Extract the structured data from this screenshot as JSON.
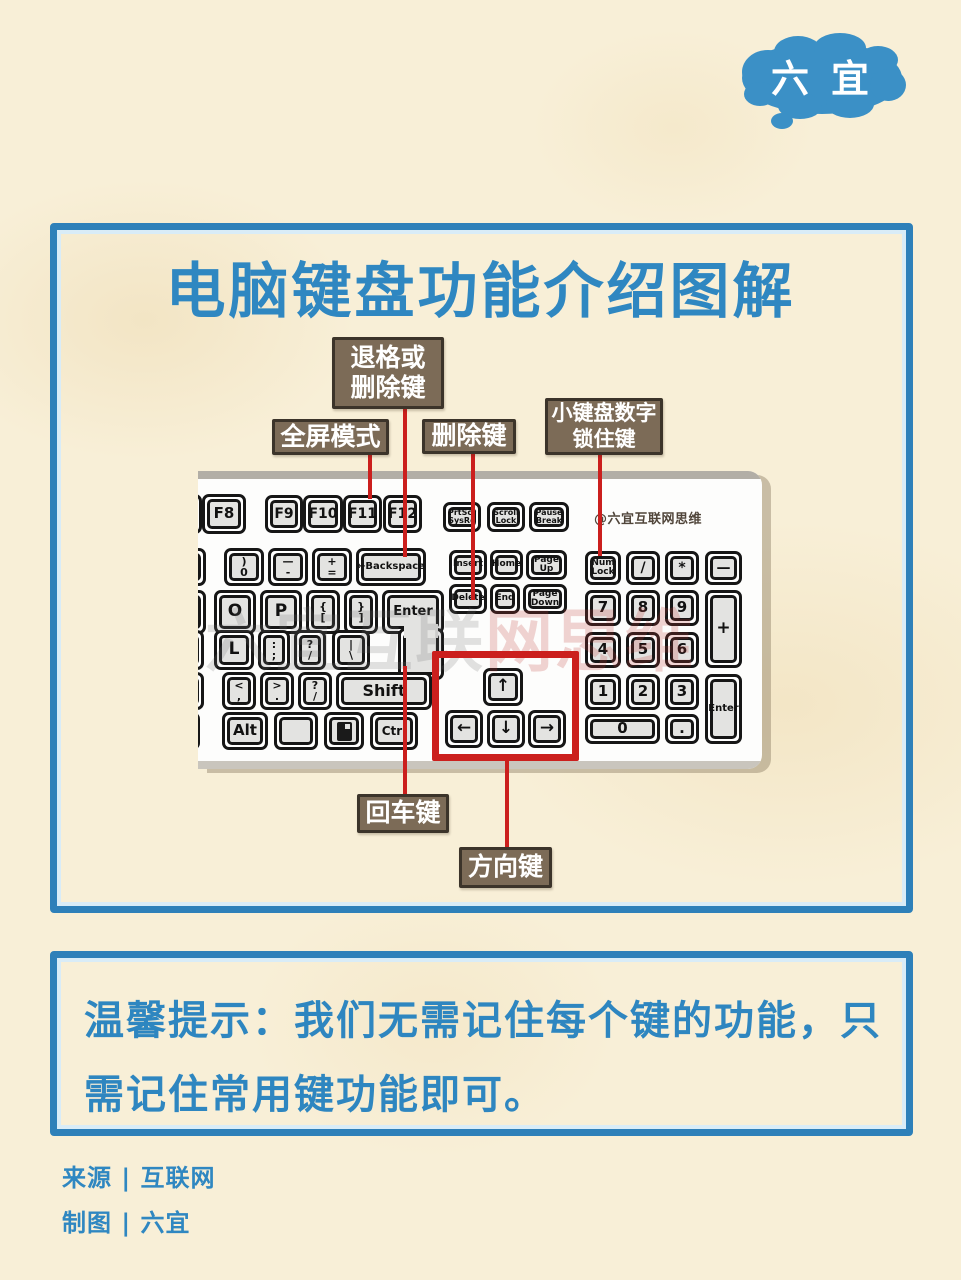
{
  "colors": {
    "accent_blue": "#2f87c1",
    "panel_border_blue": "#2e80b9",
    "label_brown": "#7c6b57",
    "label_border": "#3c342a",
    "connector_red": "#cb1f1d",
    "background_cream": "#f8efd7",
    "keycap_gray": "#e3e3e1"
  },
  "logo": {
    "chars": [
      "六",
      "宜"
    ],
    "blob_color": "#3b90c6"
  },
  "header": {
    "title": "电脑键盘功能介绍图解"
  },
  "keyboard": {
    "credit": "@六宜互联网思维",
    "watermark": {
      "gray": "六宜互联",
      "red": "网思维"
    },
    "keys": [
      {
        "x": -28,
        "y": 23,
        "w": 32,
        "h": 40,
        "lines": [],
        "name": "key-cut-left-f"
      },
      {
        "x": 4,
        "y": 23,
        "w": 44,
        "h": 40,
        "fs": 15,
        "lines": [
          "F8"
        ],
        "name": "key-f8"
      },
      {
        "x": 67,
        "y": 24,
        "w": 38,
        "h": 38,
        "fs": 14,
        "lines": [
          "F9"
        ],
        "name": "key-f9"
      },
      {
        "x": 105,
        "y": 24,
        "w": 40,
        "h": 38,
        "fs": 14,
        "lines": [
          "F10"
        ],
        "name": "key-f10"
      },
      {
        "x": 145,
        "y": 24,
        "w": 39,
        "h": 38,
        "fs": 14,
        "lines": [
          "F11"
        ],
        "name": "key-f11"
      },
      {
        "x": 185,
        "y": 24,
        "w": 39,
        "h": 38,
        "fs": 14,
        "lines": [
          "F12"
        ],
        "name": "key-f12"
      },
      {
        "x": 245,
        "y": 31,
        "w": 38,
        "h": 30,
        "fs": 8,
        "lines": [
          "PrtScr",
          "SysRq"
        ],
        "name": "key-prtscr"
      },
      {
        "x": 289,
        "y": 31,
        "w": 38,
        "h": 30,
        "fs": 8,
        "lines": [
          "Scroll",
          "Lock"
        ],
        "name": "key-scroll-lock"
      },
      {
        "x": 331,
        "y": 31,
        "w": 40,
        "h": 30,
        "fs": 8,
        "lines": [
          "Pause",
          "Break"
        ],
        "name": "key-pause"
      },
      {
        "x": -26,
        "y": 77,
        "w": 34,
        "h": 38,
        "lines": [],
        "name": "key-cut-left-num"
      },
      {
        "x": 26,
        "y": 77,
        "w": 40,
        "h": 38,
        "fs": 11,
        "lines": [
          ")",
          "0"
        ],
        "name": "key-0"
      },
      {
        "x": 70,
        "y": 77,
        "w": 40,
        "h": 38,
        "fs": 11,
        "lines": [
          "—",
          "-"
        ],
        "name": "key-minus"
      },
      {
        "x": 114,
        "y": 77,
        "w": 40,
        "h": 38,
        "fs": 11,
        "lines": [
          "+",
          "="
        ],
        "name": "key-equals"
      },
      {
        "x": 158,
        "y": 77,
        "w": 70,
        "h": 38,
        "fs": 10,
        "lines": [
          "←Backspace"
        ],
        "name": "key-backspace"
      },
      {
        "x": 251,
        "y": 79,
        "w": 38,
        "h": 30,
        "fs": 9,
        "lines": [
          "Insert"
        ],
        "name": "key-insert"
      },
      {
        "x": 292,
        "y": 79,
        "w": 33,
        "h": 30,
        "fs": 9,
        "lines": [
          "Home"
        ],
        "name": "key-home"
      },
      {
        "x": 328,
        "y": 79,
        "w": 41,
        "h": 30,
        "fs": 9,
        "lines": [
          "Page",
          "Up"
        ],
        "name": "key-page-up"
      },
      {
        "x": 251,
        "y": 113,
        "w": 38,
        "h": 30,
        "fs": 9,
        "lines": [
          "Delete"
        ],
        "name": "key-delete"
      },
      {
        "x": 292,
        "y": 113,
        "w": 30,
        "h": 30,
        "fs": 9,
        "lines": [
          "End"
        ],
        "name": "key-end"
      },
      {
        "x": 325,
        "y": 113,
        "w": 44,
        "h": 30,
        "fs": 9,
        "lines": [
          "Page",
          "Down"
        ],
        "name": "key-page-down"
      },
      {
        "x": 387,
        "y": 80,
        "w": 36,
        "h": 34,
        "fs": 9,
        "lines": [
          "Num",
          "Lock"
        ],
        "name": "key-num-lock"
      },
      {
        "x": 428,
        "y": 80,
        "w": 34,
        "h": 34,
        "fs": 14,
        "lines": [
          "/"
        ],
        "name": "key-numpad-divide"
      },
      {
        "x": 467,
        "y": 80,
        "w": 34,
        "h": 34,
        "fs": 14,
        "lines": [
          "*"
        ],
        "name": "key-numpad-multiply"
      },
      {
        "x": 507,
        "y": 80,
        "w": 37,
        "h": 34,
        "fs": 14,
        "lines": [
          "—"
        ],
        "name": "key-numpad-minus"
      },
      {
        "x": 387,
        "y": 119,
        "w": 36,
        "h": 36,
        "fs": 15,
        "lines": [
          "7"
        ],
        "name": "key-numpad-7"
      },
      {
        "x": 428,
        "y": 119,
        "w": 34,
        "h": 36,
        "fs": 15,
        "lines": [
          "8"
        ],
        "name": "key-numpad-8"
      },
      {
        "x": 467,
        "y": 119,
        "w": 34,
        "h": 36,
        "fs": 15,
        "lines": [
          "9"
        ],
        "name": "key-numpad-9"
      },
      {
        "x": 507,
        "y": 119,
        "w": 37,
        "h": 78,
        "fs": 17,
        "lines": [
          "+"
        ],
        "name": "key-numpad-plus"
      },
      {
        "x": 387,
        "y": 161,
        "w": 36,
        "h": 36,
        "fs": 15,
        "lines": [
          "4"
        ],
        "name": "key-numpad-4"
      },
      {
        "x": 428,
        "y": 161,
        "w": 34,
        "h": 36,
        "fs": 15,
        "lines": [
          "5"
        ],
        "name": "key-numpad-5"
      },
      {
        "x": 467,
        "y": 161,
        "w": 34,
        "h": 36,
        "fs": 15,
        "lines": [
          "6"
        ],
        "name": "key-numpad-6"
      },
      {
        "x": 387,
        "y": 203,
        "w": 36,
        "h": 36,
        "fs": 15,
        "lines": [
          "1"
        ],
        "name": "key-numpad-1"
      },
      {
        "x": 428,
        "y": 203,
        "w": 34,
        "h": 36,
        "fs": 15,
        "lines": [
          "2"
        ],
        "name": "key-numpad-2"
      },
      {
        "x": 467,
        "y": 203,
        "w": 34,
        "h": 36,
        "fs": 15,
        "lines": [
          "3"
        ],
        "name": "key-numpad-3"
      },
      {
        "x": 507,
        "y": 203,
        "w": 37,
        "h": 70,
        "fs": 10,
        "lines": [
          "Enter"
        ],
        "name": "key-numpad-enter"
      },
      {
        "x": 387,
        "y": 243,
        "w": 75,
        "h": 30,
        "fs": 15,
        "lines": [
          "0"
        ],
        "name": "key-numpad-0"
      },
      {
        "x": 467,
        "y": 243,
        "w": 34,
        "h": 30,
        "fs": 15,
        "lines": [
          "."
        ],
        "name": "key-numpad-dot"
      },
      {
        "x": -24,
        "y": 119,
        "w": 32,
        "h": 44,
        "lines": [],
        "name": "key-cut-left-qwerty"
      },
      {
        "x": 16,
        "y": 119,
        "w": 42,
        "h": 44,
        "fs": 17,
        "lines": [
          "O"
        ],
        "name": "key-o"
      },
      {
        "x": 62,
        "y": 119,
        "w": 42,
        "h": 44,
        "fs": 17,
        "lines": [
          "P"
        ],
        "name": "key-p"
      },
      {
        "x": 108,
        "y": 119,
        "w": 34,
        "h": 44,
        "fs": 11,
        "lines": [
          "{",
          "["
        ],
        "name": "key-bracket-open"
      },
      {
        "x": 146,
        "y": 119,
        "w": 34,
        "h": 44,
        "fs": 11,
        "lines": [
          "}",
          "]"
        ],
        "name": "key-bracket-close"
      },
      {
        "x": 184,
        "y": 119,
        "w": 62,
        "h": 44,
        "fs": 13,
        "lines": [
          "Enter"
        ],
        "name": "key-enter"
      },
      {
        "x": 200,
        "y": 157,
        "w": 46,
        "h": 52,
        "lines": [],
        "name": "key-enter-lower"
      },
      {
        "type": "patch",
        "x": 206,
        "y": 153,
        "w": 34,
        "h": 14,
        "name": "key-enter-joint"
      },
      {
        "x": -26,
        "y": 159,
        "w": 32,
        "h": 40,
        "lines": [],
        "name": "key-cut-left-home"
      },
      {
        "x": 16,
        "y": 159,
        "w": 40,
        "h": 40,
        "fs": 17,
        "lines": [
          "L"
        ],
        "name": "key-l"
      },
      {
        "x": 60,
        "y": 159,
        "w": 32,
        "h": 40,
        "fs": 11,
        "lines": [
          ":",
          ";"
        ],
        "name": "key-semicolon"
      },
      {
        "x": 96,
        "y": 159,
        "w": 32,
        "h": 40,
        "fs": 11,
        "lines": [
          "?",
          "/"
        ],
        "name": "key-quote"
      },
      {
        "x": 134,
        "y": 159,
        "w": 38,
        "h": 40,
        "fs": 11,
        "lines": [
          "|",
          "\\"
        ],
        "name": "key-backslash"
      },
      {
        "x": -26,
        "y": 201,
        "w": 32,
        "h": 38,
        "lines": [],
        "name": "key-cut-left-shift-row"
      },
      {
        "x": 24,
        "y": 201,
        "w": 34,
        "h": 38,
        "fs": 11,
        "lines": [
          "<",
          ","
        ],
        "name": "key-comma"
      },
      {
        "x": 62,
        "y": 201,
        "w": 34,
        "h": 38,
        "fs": 11,
        "lines": [
          ">",
          "."
        ],
        "name": "key-period"
      },
      {
        "x": 100,
        "y": 201,
        "w": 34,
        "h": 38,
        "fs": 11,
        "lines": [
          "?",
          "/"
        ],
        "name": "key-slash"
      },
      {
        "x": 138,
        "y": 201,
        "w": 96,
        "h": 38,
        "fs": 16,
        "lines": [
          "Shift"
        ],
        "name": "key-shift"
      },
      {
        "x": -26,
        "y": 241,
        "w": 28,
        "h": 38,
        "lines": [],
        "name": "key-cut-left-bottom"
      },
      {
        "x": 24,
        "y": 241,
        "w": 46,
        "h": 38,
        "fs": 15,
        "lines": [
          "Alt"
        ],
        "name": "key-alt"
      },
      {
        "x": 76,
        "y": 241,
        "w": 44,
        "h": 38,
        "type": "win",
        "lines": [],
        "name": "key-windows"
      },
      {
        "x": 126,
        "y": 241,
        "w": 40,
        "h": 38,
        "type": "menu",
        "lines": [],
        "name": "key-menu"
      },
      {
        "x": 172,
        "y": 241,
        "w": 48,
        "h": 38,
        "fs": 12,
        "lines": [
          "Ctrl"
        ],
        "name": "key-ctrl"
      },
      {
        "x": 285,
        "y": 197,
        "w": 40,
        "h": 38,
        "fs": 17,
        "lines": [
          "↑"
        ],
        "name": "key-arrow-up"
      },
      {
        "x": 247,
        "y": 239,
        "w": 38,
        "h": 38,
        "fs": 17,
        "lines": [
          "←"
        ],
        "name": "key-arrow-left"
      },
      {
        "x": 289,
        "y": 239,
        "w": 38,
        "h": 38,
        "fs": 17,
        "lines": [
          "↓"
        ],
        "name": "key-arrow-down"
      },
      {
        "x": 330,
        "y": 239,
        "w": 38,
        "h": 38,
        "fs": 17,
        "lines": [
          "→"
        ],
        "name": "key-arrow-right"
      }
    ]
  },
  "callouts": [
    {
      "id": "backspace-label",
      "x": 332,
      "y": 337,
      "w": 112,
      "h": 72,
      "fs": 25,
      "lines": [
        "退格或",
        "删除键"
      ]
    },
    {
      "id": "fullscreen-label",
      "x": 272,
      "y": 419,
      "w": 117,
      "h": 36,
      "fs": 25,
      "lines": [
        "全屏模式"
      ]
    },
    {
      "id": "delete-label",
      "x": 422,
      "y": 419,
      "w": 94,
      "h": 35,
      "fs": 25,
      "lines": [
        "删除键"
      ]
    },
    {
      "id": "numlock-label",
      "x": 545,
      "y": 398,
      "w": 118,
      "h": 57,
      "fs": 21,
      "lines": [
        "小键盘数字",
        "锁住键"
      ]
    },
    {
      "id": "enter-label",
      "x": 357,
      "y": 794,
      "w": 92,
      "h": 39,
      "fs": 25,
      "lines": [
        "回车键"
      ]
    },
    {
      "id": "arrows-label",
      "x": 459,
      "y": 847,
      "w": 93,
      "h": 41,
      "fs": 25,
      "lines": [
        "方向键"
      ]
    }
  ],
  "lines": [
    {
      "id": "fullscreen-line",
      "x": 368,
      "y": 453,
      "h": 46
    },
    {
      "id": "backspace-line",
      "x": 403,
      "y": 407,
      "h": 150
    },
    {
      "id": "delete-line",
      "x": 471,
      "y": 452,
      "h": 148
    },
    {
      "id": "numlock-line",
      "x": 598,
      "y": 453,
      "h": 103
    },
    {
      "id": "enter-line",
      "x": 403,
      "y": 666,
      "h": 130
    },
    {
      "id": "arrows-line",
      "x": 505,
      "y": 755,
      "h": 94
    }
  ],
  "tip": {
    "line1": "温馨提示：我们无需记住每个键的功能，只",
    "line2": "需记住常用键功能即可。"
  },
  "footer": {
    "source": "来源 | 互联网",
    "credit": "制图 | 六宜"
  }
}
